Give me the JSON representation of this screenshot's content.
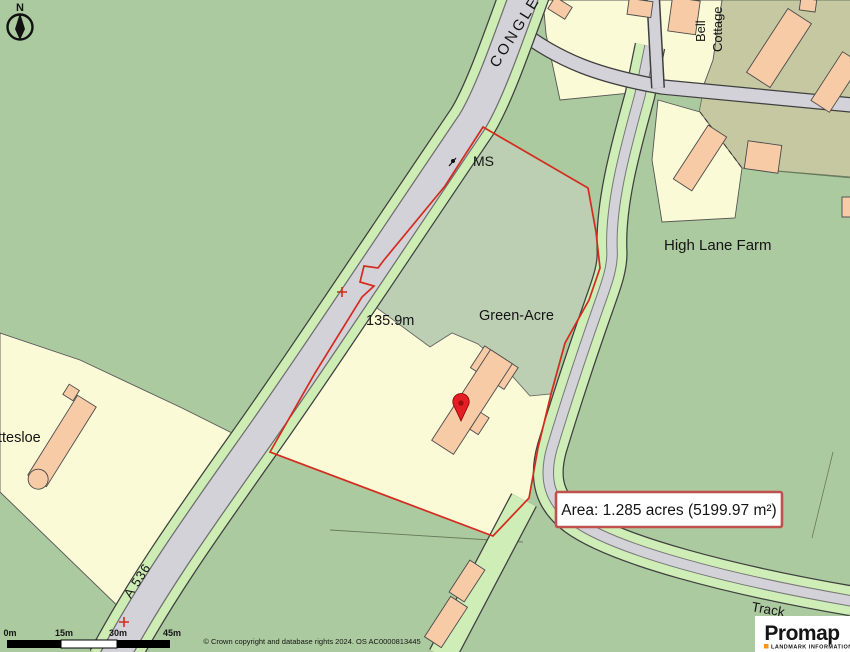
{
  "map": {
    "labels": {
      "road_top": "CONGLE",
      "ms": "MS",
      "spot_height": "135.9m",
      "green_acre": "Green-Acre",
      "high_lane_farm": "High Lane Farm",
      "bell": "Bell",
      "cottage": "Cottage",
      "ttesloe": "ttesloe",
      "a536": "A 536",
      "track": "Track"
    },
    "compass_n": "N",
    "colors": {
      "field_green": "#ACCA9F",
      "parcel_field_green": "#BCCFB3",
      "verge_green": "#CDEDB4",
      "road_gray": "#D3D2D8",
      "farmyard_olive": "#C6C8A2",
      "parcel_yellow": "#FBFAD7",
      "building_peach": "#F6CBA6",
      "boundary_red": "#D42B1E",
      "pin_red": "#E31E24"
    }
  },
  "annotation": {
    "area_text": "Area: 1.285 acres (5199.97 m²)",
    "border_color": "#C0504D"
  },
  "scalebar": {
    "labels": [
      "0m",
      "15m",
      "30m",
      "45m"
    ]
  },
  "footer": {
    "copyright": "© Crown copyright and database rights 2024. OS AC0000813445"
  },
  "logo": {
    "name": "Promap",
    "tagline": "LANDMARK INFORMATION",
    "accent": "#F7941D"
  }
}
